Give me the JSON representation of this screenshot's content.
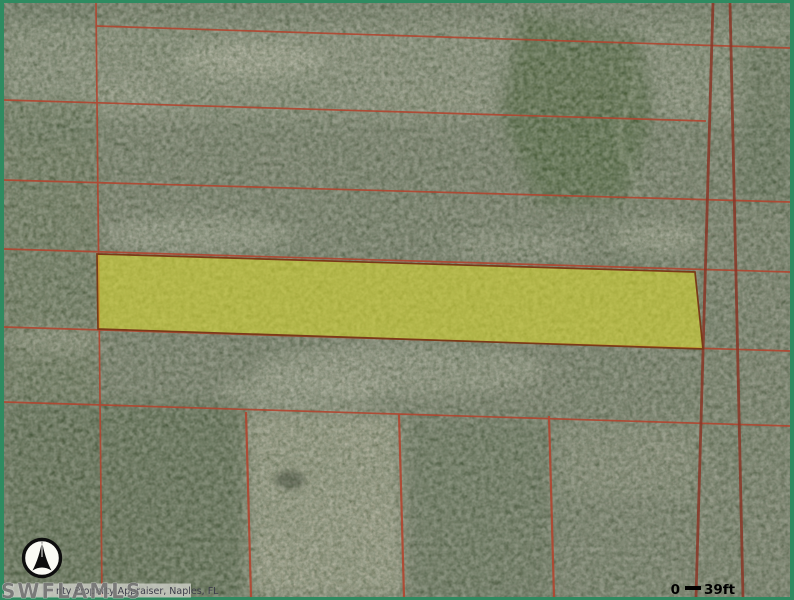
{
  "map": {
    "type": "aerial-parcel-map",
    "watermark": "SWFLAMLS",
    "attribution": "nty Property Appraiser, Naples, FL",
    "scale_bar": {
      "start_label": "0",
      "end_label": "39ft"
    },
    "compass": "north-arrow",
    "highlighted_parcel": {
      "points": "97,254 695,272 703,349 98,329",
      "fill": "#dede2a",
      "fill_opacity": "0.55",
      "outline": "#7a3a18"
    },
    "colors": {
      "frame_green": "#2f8b61",
      "parcel_line_red": "#b2452f",
      "road_line_maroon": "#8a3626",
      "scale_text": "#000000",
      "attribution_text": "#3d3d4a",
      "watermark_gray": "#6e6e6e"
    }
  }
}
